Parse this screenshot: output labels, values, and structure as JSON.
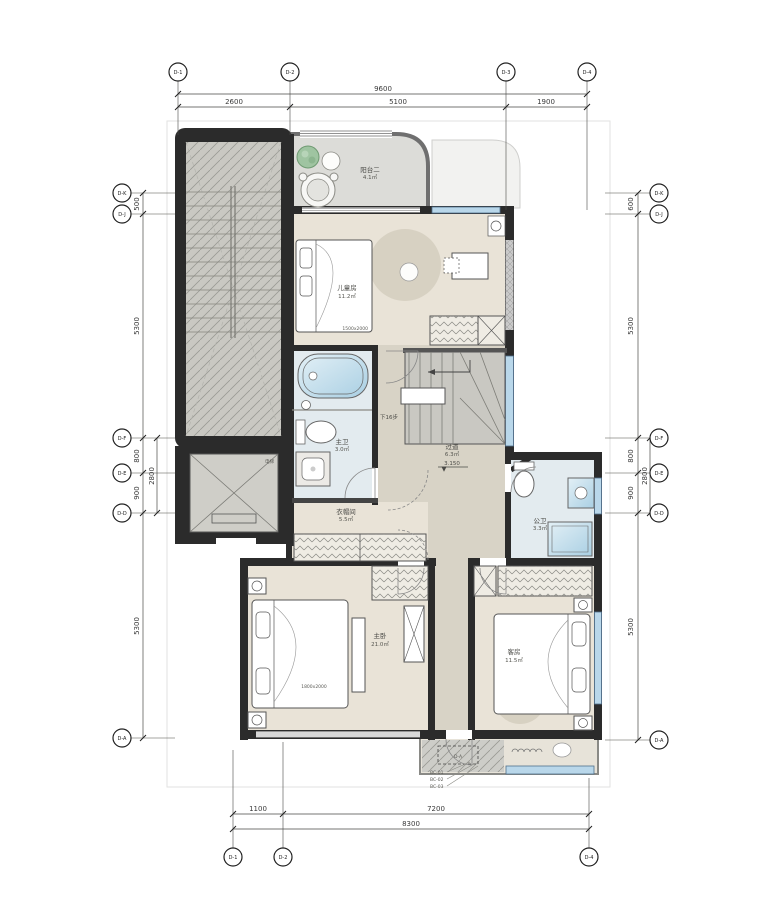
{
  "drawing": {
    "rooms": {
      "balcony2": {
        "label": "阳台二",
        "area": "4.1㎡"
      },
      "children_room": {
        "label": "儿童房",
        "area": "11.2㎡",
        "bed_tag": "1500x2000"
      },
      "master_bath": {
        "label": "主卫",
        "area": "3.0㎡"
      },
      "corridor": {
        "label": "过道",
        "area": "6.3㎡",
        "level": "3.150"
      },
      "stair": {
        "note": "下16步"
      },
      "cloakroom": {
        "label": "衣帽间",
        "area": "5.5㎡"
      },
      "public_bath": {
        "label": "公卫",
        "area": "3.3㎡"
      },
      "master_bedroom": {
        "label": "主卧",
        "area": "21.0㎡",
        "bed_tag": "1800x2000"
      },
      "guest_room": {
        "label": "客房",
        "area": "11.5㎡"
      },
      "elevator": {
        "label": "电梯"
      }
    },
    "annotations": {
      "bc_notes": [
        "BC-01",
        "BC-02",
        "BC-03"
      ],
      "equipment_tag": "D-A"
    },
    "dimensions": {
      "top": {
        "overall": "9600",
        "segments": [
          "2600",
          "5100",
          "1900"
        ]
      },
      "bottom": {
        "overall": "8300",
        "segments": [
          "1100",
          "7200"
        ]
      },
      "left": {
        "segments": [
          "500",
          "5300",
          "800",
          "900",
          "5300"
        ],
        "inner": "2800"
      },
      "right": {
        "segments": [
          "600",
          "5300",
          "800",
          "900",
          "5300"
        ],
        "inner": "2800"
      }
    },
    "grid_bubbles": {
      "top": [
        "D-1",
        "D-2",
        "D-3",
        "D-4"
      ],
      "left": [
        "D-K",
        "D-J",
        "D-F",
        "D-E",
        "D-D",
        "D-A"
      ],
      "right": [
        "D-K",
        "D-J",
        "D-F",
        "D-E",
        "D-D",
        "D-A"
      ],
      "bottom": [
        "D-1",
        "D-2",
        "D-4"
      ]
    },
    "colors": {
      "wall": "#2b2b2b",
      "floor": "#e9e3d7",
      "corridor_floor": "#d8d3c6",
      "balcony_floor": "#dcdcd8",
      "wet_floor": "#e3ebef",
      "glazing": "#b9d7ea",
      "plant": "#9fc4a1"
    }
  }
}
